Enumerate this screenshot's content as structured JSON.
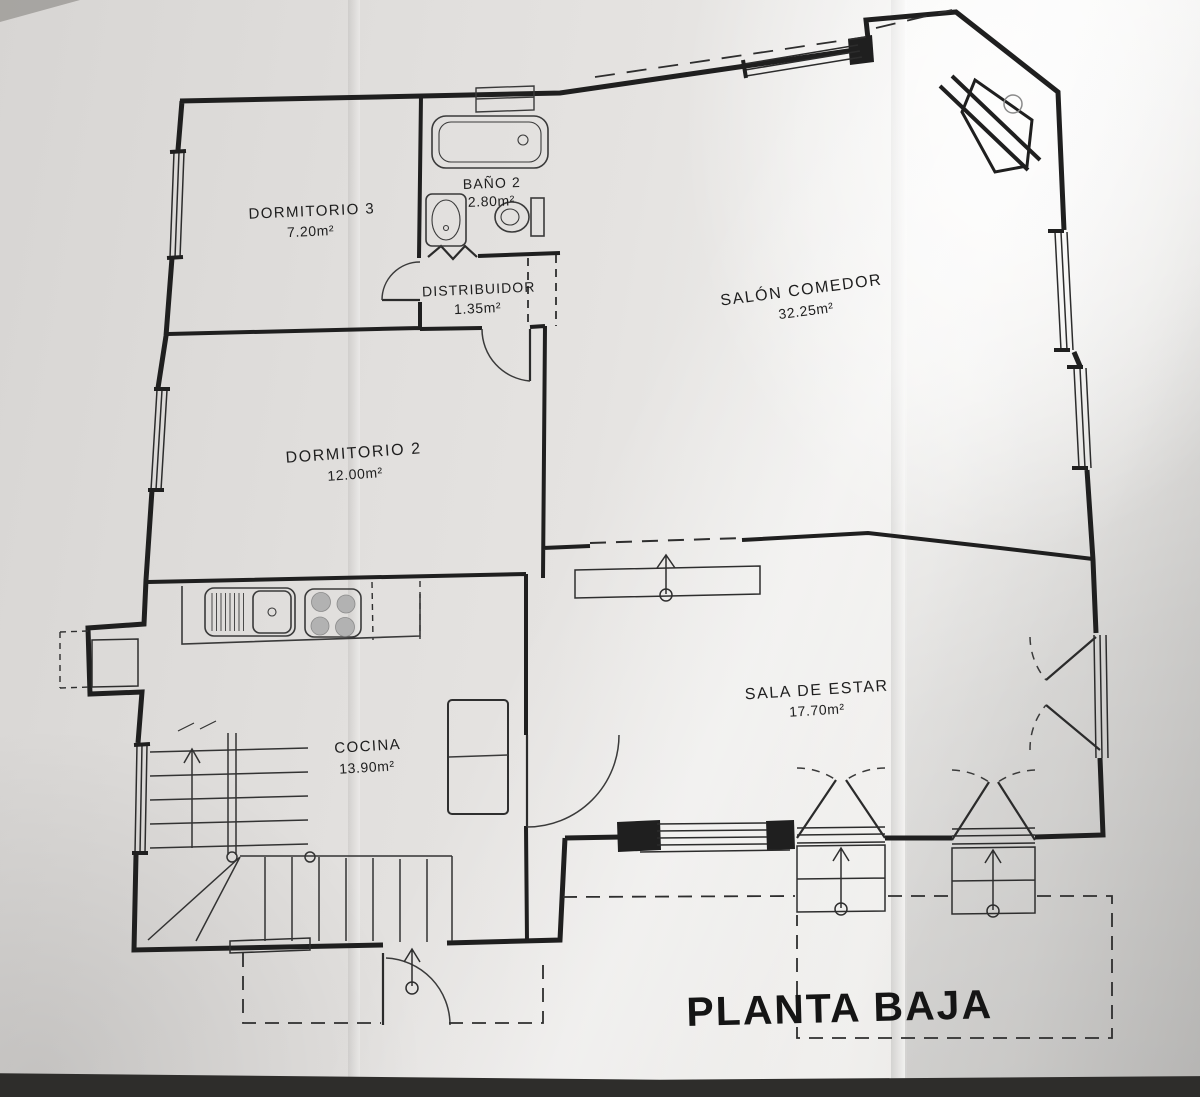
{
  "title": "PLANTA BAJA",
  "rooms": {
    "dormitorio3": {
      "name": "DORMITORIO 3",
      "area": "7.20m²"
    },
    "bano2": {
      "name": "BAÑO 2",
      "area": "2.80m²"
    },
    "distribuidor": {
      "name": "DISTRIBUIDOR",
      "area": "1.35m²"
    },
    "salon": {
      "name": "SALÓN COMEDOR",
      "area": "32.25m²"
    },
    "dormitorio2": {
      "name": "DORMITORIO 2",
      "area": "12.00m²"
    },
    "sala": {
      "name": "SALA DE ESTAR",
      "area": "17.70m²"
    },
    "cocina": {
      "name": "COCINA",
      "area": "13.90m²"
    }
  },
  "colors": {
    "ink": "#1f1f1f",
    "fixture_line": "#3a3a3a",
    "paper": "#e5e3e1",
    "paper_bright": "#f2f1ef",
    "paper_shadow": "#c9c8c6",
    "photo_edge": "#2e2d2b",
    "burner_fill": "#b2b2b2"
  }
}
